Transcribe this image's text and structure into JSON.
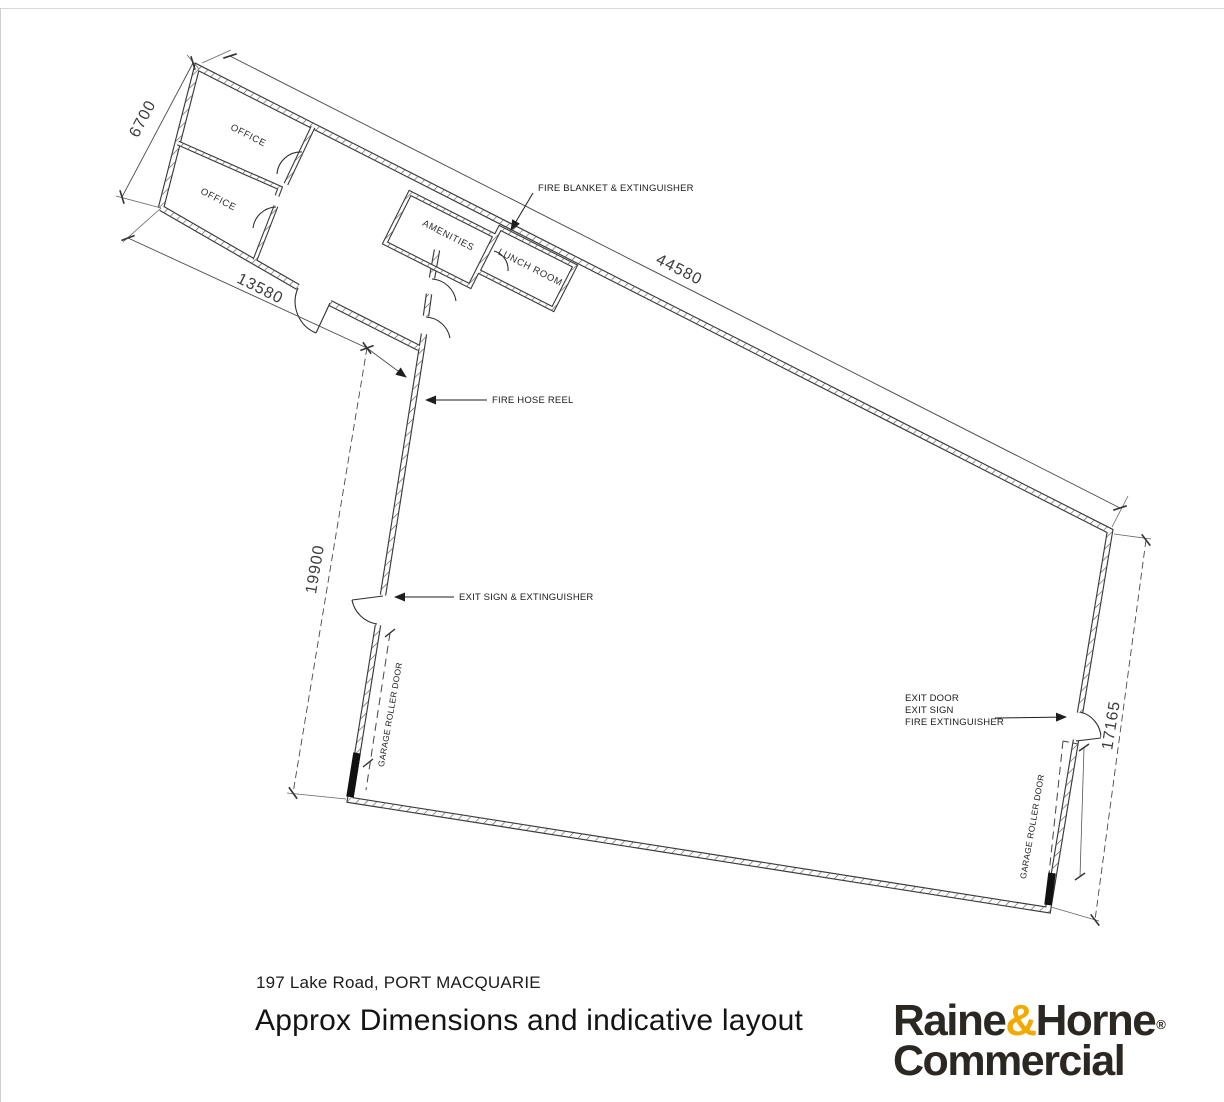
{
  "plan": {
    "rooms": {
      "office_top": "OFFICE",
      "office_bottom": "OFFICE",
      "amenities": "AMENITIES",
      "lunch_room": "LUNCH ROOM"
    },
    "dimensions": {
      "office_width": "6700",
      "office_length": "13580",
      "top_wall": "44580",
      "warehouse_left": "19900",
      "warehouse_right": "17165"
    },
    "annotations": {
      "fire_blanket": "FIRE BLANKET & EXTINGUISHER",
      "fire_hose_reel": "FIRE HOSE REEL",
      "exit_sign_extinguisher": "EXIT SIGN & EXTINGUISHER",
      "exit_door_line1": "EXIT DOOR",
      "exit_door_line2": "EXIT SIGN",
      "exit_door_line3": "FIRE EXTINGUISHER",
      "garage_door_left": "GARAGE ROLLER DOOR",
      "garage_door_right": "GARAGE ROLLER DOOR"
    }
  },
  "footer": {
    "address": "197 Lake Road, PORT MACQUARIE",
    "title": "Approx Dimensions and indicative layout",
    "logo": {
      "name_part1": "Raine",
      "ampersand": "&",
      "name_part2": "Horne",
      "registered": "®",
      "line2": "Commercial",
      "accent_color": "#F2A900",
      "text_color": "#2B2722"
    }
  }
}
